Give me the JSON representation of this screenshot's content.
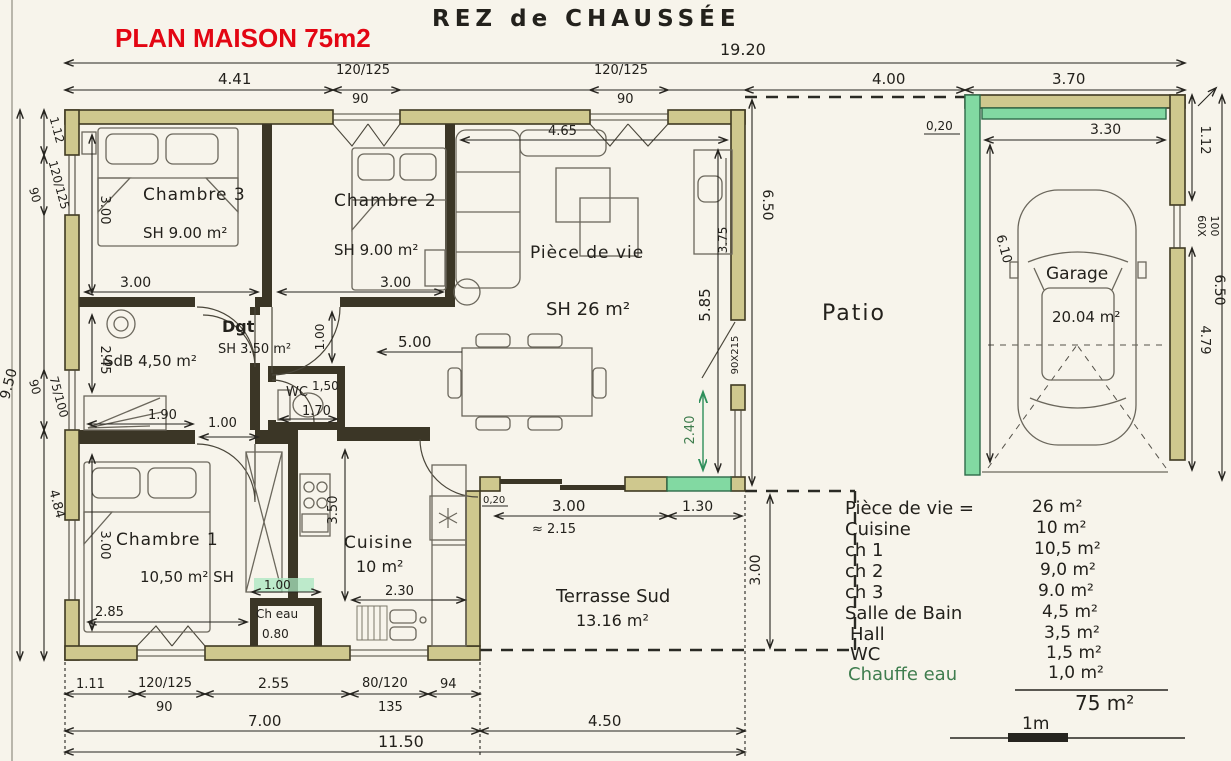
{
  "header": {
    "plan_title": "PLAN MAISON 75m2",
    "floor_title": "REZ de CHAUSSÉE"
  },
  "rooms": {
    "chambre3": {
      "name": "Chambre 3",
      "area": "SH 9.00 m²"
    },
    "chambre2": {
      "name": "Chambre 2",
      "area": "SH 9.00 m²"
    },
    "piece_de_vie": {
      "name": "Pièce de vie",
      "area": "SH 26 m²"
    },
    "degagement": {
      "name": "Dgt",
      "area": "SH 3.50 m²"
    },
    "salle_de_bain": {
      "name": "SdB 4,50 m²"
    },
    "wc": {
      "name": "WC",
      "area": "1,50"
    },
    "chambre1": {
      "name": "Chambre 1",
      "area": "10,50 m² SH"
    },
    "cuisine": {
      "name": "Cuisine",
      "area": "10 m²"
    },
    "chauffe_eau": {
      "name": "Ch eau"
    },
    "patio": {
      "name": "Patio"
    },
    "garage": {
      "name": "Garage",
      "area": "20.04 m²"
    },
    "terrasse": {
      "name": "Terrasse Sud",
      "area": "13.16 m²"
    }
  },
  "dims": {
    "overall_width": "19.20",
    "top_441": "4.41",
    "top_window1": "120/125",
    "top_window1_sub": "90",
    "top_window2": "120/125",
    "top_window2_sub": "90",
    "top_patio": "4.00",
    "top_garage": "3.70",
    "garage_inner_width": "3.30",
    "garage_wall": "0,20",
    "garage_height": "6.10",
    "right_112": "1.12",
    "right_window": "60X",
    "right_window_sub": "100",
    "right_479": "4.79",
    "right_650": "6.50",
    "patio_650": "6.50",
    "left_950": "9.50",
    "left_112": "1.12",
    "left_window1": "120/125",
    "left_window1_sub": "90",
    "left_window2": "75/100",
    "left_window2_sub": "90",
    "left_484": "4.84",
    "ch3_w": "3.00",
    "ch3_h": "3.00",
    "ch2_w": "3.00",
    "pdv_465": "4.65",
    "pdv_585": "5.85",
    "pdv_500": "5.00",
    "pdv_375": "3.75",
    "pdv_door": "90X215",
    "pdv_240": "2.40",
    "dgt_100": "1.00",
    "sdb_245": "2.45",
    "sdb_190": "1.90",
    "wc_100": "1.00",
    "wc_170": "1.70",
    "ch1_h": "3.00",
    "ch1_w": "2.85",
    "cuisine_350": "3.50",
    "cuisine_230": "2.30",
    "cheau_100": "1.00",
    "cheau_080": "0.80",
    "terr_020": "0,20",
    "terr_300": "3.00",
    "terr_215": "≈ 2.15",
    "terr_130": "1.30",
    "terr_300r": "3.00",
    "bot_111": "1.11",
    "bot_window1": "120/125",
    "bot_window1_sub": "90",
    "bot_255": "2.55",
    "bot_window2": "80/120",
    "bot_window2_sub": "135",
    "bot_94": "94",
    "bot_700": "7.00",
    "bot_450": "4.50",
    "bot_1150": "11.50"
  },
  "legend": {
    "rows": [
      {
        "label": "Pièce de vie =",
        "value": "26 m²"
      },
      {
        "label": "Cuisine",
        "value": "10 m²"
      },
      {
        "label": "ch 1",
        "value": "10,5 m²"
      },
      {
        "label": "ch 2",
        "value": "9,0 m²"
      },
      {
        "label": "ch 3",
        "value": "9.0 m²"
      },
      {
        "label": "Salle de Bain",
        "value": "4,5 m²"
      },
      {
        "label": "Hall",
        "value": "3,5 m²"
      },
      {
        "label": "WC",
        "value": "1,5 m²"
      },
      {
        "label": "Chauffe eau",
        "value": "1,0 m²"
      }
    ],
    "total": "75 m²",
    "scale_label": "1m"
  }
}
